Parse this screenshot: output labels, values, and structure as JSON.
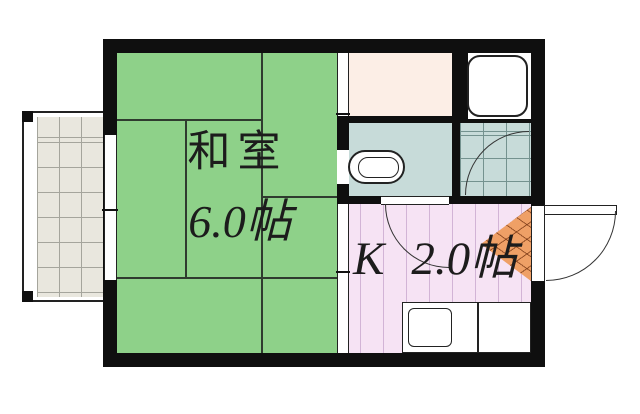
{
  "plan_type": "apartment-floor-plan",
  "rooms": {
    "japanese_room": {
      "name": "和室",
      "size": "6.0帖",
      "color": "#8ed189"
    },
    "kitchen": {
      "abbr": "K",
      "size": "2.0帖",
      "color": "#f6e3f4"
    },
    "bath": {
      "color": "#c7dbd9"
    },
    "closet": {
      "color": "#fceee6"
    },
    "laundry_room": {
      "color": "#ffffff"
    },
    "tiled_room": {
      "color": "#c7dbd9"
    },
    "entrance_step": {
      "color": "#efa066"
    },
    "balcony": {
      "color": "#e9e7de"
    }
  },
  "colors": {
    "wall": "#0f0f0f",
    "outline": "#222222",
    "tatami_line": "#2f3b2f",
    "kitchen_stripe": "#d2b4d6",
    "tile_grid": "#74928f",
    "balcony_grid": "#a5a59c",
    "hatch_line": "#783714"
  },
  "icons": {
    "bathtub": "bathtub-icon",
    "washer_pan": "washing-machine-pan-icon",
    "kitchen_sink": "kitchen-sink-icon",
    "door_swing": "door-swing-arc",
    "door_leaf": "entrance-door-leaf"
  }
}
